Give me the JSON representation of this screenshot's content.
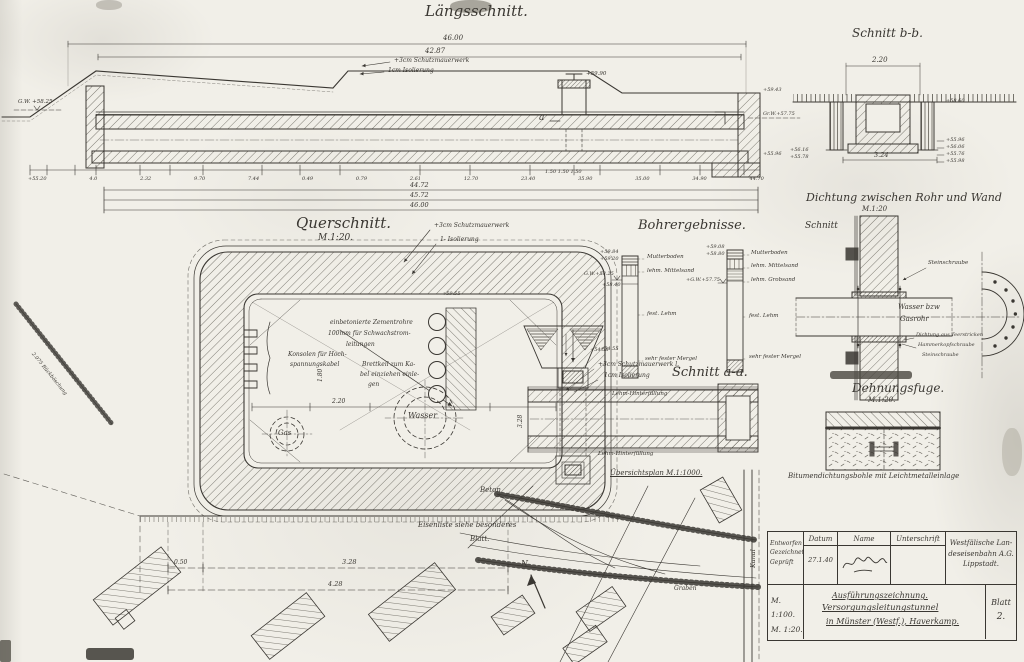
{
  "palette": {
    "paper": "#f1efe8",
    "ink": "#3a3732",
    "pencil": "#6f6a60"
  },
  "laengsschnitt": {
    "title": "Längsschnitt.",
    "dim_top1": "46.00",
    "dim_top2": "42.87",
    "note_wall": "+3cm Schutzmauerwerk",
    "note_iso": "1cm Isolierung",
    "gw_left": "G.W. +58.25",
    "shaft_elev": "+59.90",
    "label_a": "a",
    "elev_right_top": "+59.43",
    "elev_right_gw": "Gr.W.+57.75",
    "elev_right_bottom": "+55.96",
    "chain": [
      "+55.20",
      "4.0",
      "2.32",
      "9.70",
      "7.44",
      "0.49",
      "0.79",
      "2.61",
      "12.70",
      "23.40",
      "35.90",
      "35.00",
      "34.90",
      "44.70"
    ],
    "sub_chain": "1.50   1.50   1.50",
    "dim_bottom1": "44.72",
    "dim_bottom2": "45.72",
    "dim_bottom3": "46.00"
  },
  "schnitt_bb": {
    "title": "Schnitt b-b.",
    "dim_top": "2.20",
    "dim_bottom": "3.24",
    "elev_right": [
      "+58.60",
      "+55.96",
      "+56.06",
      "+55.76",
      "+55.98"
    ],
    "elev_left": [
      "+56.16",
      "+55.78"
    ]
  },
  "querschnitt": {
    "title": "Querschnitt.",
    "scale": "M.1:20.",
    "note_wall": "+3cm Schutzmauerwerk",
    "note_iso": "1- Isolierung",
    "elev_top": "+59.55",
    "zementrohre_1": "einbetonierte Zementrohre",
    "zementrohre_2": "100mm für Schwachstrom-",
    "zementrohre_3": "leitungen",
    "konsolen_1": "Konsolen für Hoch-",
    "konsolen_2": "spannungskabel",
    "brett_1": "Brettkeil zum Ka-",
    "brett_2": "bel einziehen einle-",
    "brett_3": "gen",
    "gas": "Gas",
    "wasser": "Wasser",
    "dim_inner_w": "2.20",
    "dim_inner_h": "1.80",
    "beton": "Beton",
    "dim_b1": "0.50",
    "dim_b2": "3.28",
    "dim_b3": "4.28",
    "eisenliste_1": "Eisenliste siehe besonderes",
    "eisenliste_2": "Blatt."
  },
  "bohrergebnisse": {
    "title": "Bohrergebnisse.",
    "left": {
      "elev_top1": "+59.84",
      "elev_top2": "+59.20",
      "gw": "G.W.+58.25",
      "elev_mid": "+58.40",
      "elev_low": "+54.55",
      "layers": [
        "Mutterboden",
        "lehm. Mittelsand",
        "fest. Lehm",
        "sehr fester Mergel"
      ]
    },
    "right": {
      "elev_top1": "+59.08",
      "elev_top2": "+58.80",
      "gw": "+G.W.+57.75",
      "layers": [
        "Mutterboden",
        "lehm. Mittelsand",
        "lehm. Grobsand",
        "fest. Lehm",
        "sehr fester Mergel"
      ]
    }
  },
  "schnitt_aa": {
    "title": "Schnitt a-a.",
    "note_wall": "+3cm Schutzmauerwerk l.",
    "note_iso": "1cm Isolierung",
    "lehm_top": "Lehm-Hinterfüllung",
    "lehm_bottom": "Lehm-Hinterfüllung",
    "elev": "+54.55",
    "dim_left": "3.28"
  },
  "dichtung": {
    "title": "Dichtung zwischen Rohr und Wand",
    "scale": "M.1:20",
    "schnitt": "Schnitt",
    "pipe1": "Wasser bzw",
    "pipe2": "Gasrohr",
    "note_stein_top": "Steinschraube",
    "note_teer": "Dichtung aus Teerstricken",
    "note_hammer": "Hammerkopfschraube",
    "note_stein_bottom": "Steinschraube"
  },
  "dehnungsfuge": {
    "title": "Dehnungsfuge.",
    "scale": "M.1:20.",
    "caption": "Bitumendichtungsbohle mit Leichtmetalleinlage"
  },
  "siteplan": {
    "title": "Übersichtsplan M.1:1000.",
    "kanal": "Kanal",
    "graben": "Graben",
    "north": "N",
    "slope_note": "2.075 Rückböschung"
  },
  "titleblock": {
    "col_datum": "Datum",
    "col_name": "Name",
    "col_unterschrift": "Unterschrift",
    "row1": "Entworfen",
    "row2": "Gezeichnet",
    "row3": "Geprüft",
    "date": "27.1.40",
    "company1": "Westfälische Lan-",
    "company2": "deseisenbahn A.G.",
    "company3": "Lippstadt.",
    "scale1": "M. 1:100.",
    "scale2": "M. 1:20.",
    "doc_type": "Ausführungszeichnung.",
    "doc_title1": "Versorgungsleitungstunnel",
    "doc_title2": "in Münster (Westf.), Haverkamp.",
    "blatt_label": "Blatt",
    "blatt_no": "2."
  }
}
